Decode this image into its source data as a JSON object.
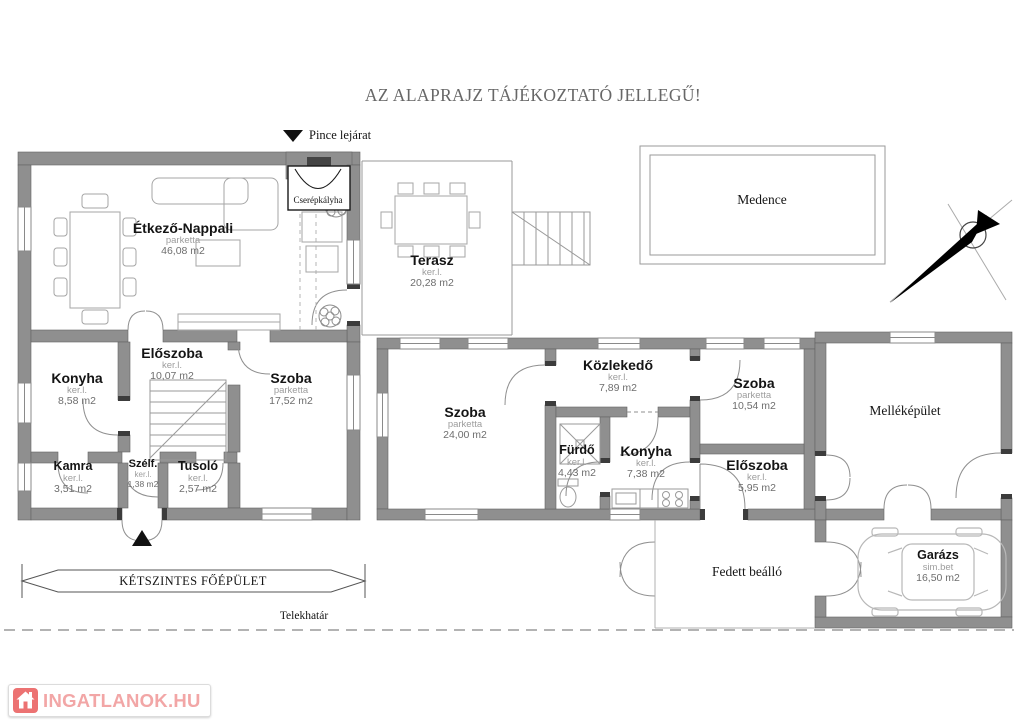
{
  "title": "AZ ALAPRAJZ TÁJÉKOZTATÓ JELLEGŰ!",
  "labels": {
    "pince_lejarat": "Pince lejárat",
    "cserepkalyha": "Cserépkályha",
    "medence": "Medence",
    "mellekepulet": "Melléképület",
    "fedett_beallo": "Fedett beálló",
    "ketszintes_foepulet": "KÉTSZINTES FŐÉPÜLET",
    "telekhatar": "Telekhatár"
  },
  "rooms": {
    "etkezo_nappali": {
      "name": "Étkező-Nappali",
      "floor": "parketta",
      "area": "46,08 m2"
    },
    "terasz": {
      "name": "Terasz",
      "floor": "ker.l.",
      "area": "20,28 m2"
    },
    "konyha_fo": {
      "name": "Konyha",
      "floor": "ker.l.",
      "area": "8,58 m2"
    },
    "eloszoba_fo": {
      "name": "Előszoba",
      "floor": "ker.l.",
      "area": "10,07 m2"
    },
    "szoba_fo": {
      "name": "Szoba",
      "floor": "parketta",
      "area": "17,52 m2"
    },
    "kamra": {
      "name": "Kamra",
      "floor": "ker.l.",
      "area": "3,51 m2"
    },
    "szelfogo": {
      "name": "Szélf.",
      "floor": "ker.l.",
      "area": "1,38 m2"
    },
    "tusolo": {
      "name": "Tusoló",
      "floor": "ker.l.",
      "area": "2,57 m2"
    },
    "szoba_kozep": {
      "name": "Szoba",
      "floor": "parketta",
      "area": "24,00 m2"
    },
    "kozlekedo": {
      "name": "Közlekedő",
      "floor": "ker.l.",
      "area": "7,89 m2"
    },
    "furdo": {
      "name": "Fürdő",
      "floor": "ker.l.",
      "area": "4,43 m2"
    },
    "konyha_kozep": {
      "name": "Konyha",
      "floor": "ker.l.",
      "area": "7,38 m2"
    },
    "szoba_jobb": {
      "name": "Szoba",
      "floor": "parketta",
      "area": "10,54 m2"
    },
    "eloszoba_jobb": {
      "name": "Előszoba",
      "floor": "ker.l.",
      "area": "5,95 m2"
    },
    "garazs": {
      "name": "Garázs",
      "floor": "sim.bet",
      "area": "16,50 m2"
    }
  },
  "logo": {
    "text": "INGATLANOK.HU"
  },
  "colors": {
    "wall": "#8f8f8f",
    "thin_line": "#9a9a9a",
    "logo_red": "#ec7272",
    "logo_text": "#f2a6a6",
    "title_gray": "#676767"
  }
}
